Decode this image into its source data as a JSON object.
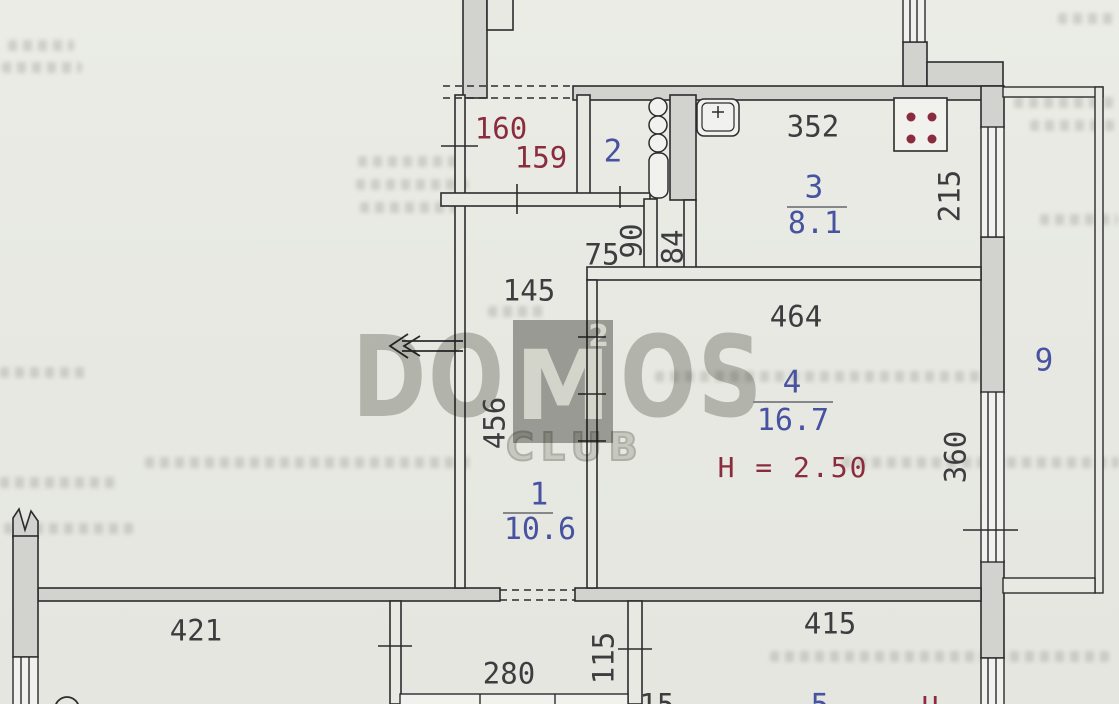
{
  "rooms": [
    {
      "number": "1",
      "area": "10.6"
    },
    {
      "number": "2"
    },
    {
      "number": "3",
      "area": "8.1"
    },
    {
      "number": "4",
      "area": "16.7",
      "ceiling_height": "H = 2.50"
    },
    {
      "number": "5"
    },
    {
      "number": "9"
    }
  ],
  "dimensions": {
    "red": [
      "160",
      "159"
    ],
    "black": [
      "352",
      "215",
      "145",
      "75",
      "90",
      "84",
      "464",
      "456",
      "360",
      "421",
      "280",
      "115",
      "415",
      "15"
    ],
    "partial_bottom": "H"
  },
  "watermark": {
    "left": "DO",
    "m": "M",
    "sup": "2",
    "right": "OS",
    "club": "CLUB"
  },
  "colors": {
    "paper": "#e8e9e3",
    "wall_line": "#2c2c2e",
    "wall_fill": "#d2d2ce",
    "room_label_blue": "#4753a0",
    "dimension_red": "#8a2c3e",
    "dimension_black": "#3d3d3f",
    "watermark_gray": "#c5c6c2"
  }
}
